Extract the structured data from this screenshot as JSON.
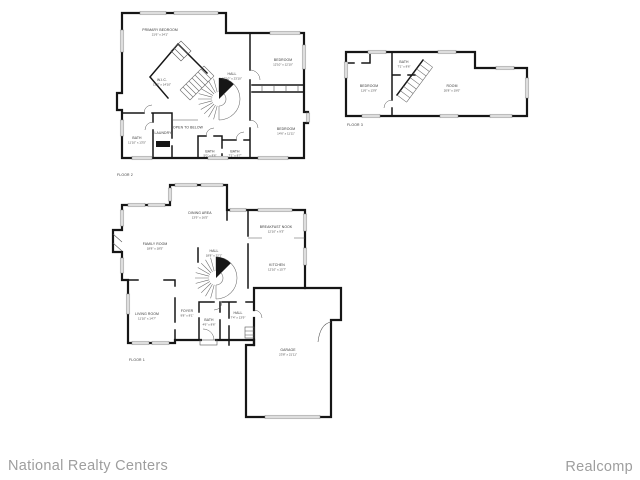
{
  "page": {
    "background": "#ffffff"
  },
  "colors": {
    "wall": "#161616",
    "window": "#dedede",
    "stair": "#6a6a6a",
    "label": "#333333",
    "footer": "#9e9e9e"
  },
  "footer": {
    "left": "National Realty Centers",
    "right": "Realcomp"
  },
  "floor2": {
    "label": "FLOOR 2",
    "rooms": [
      {
        "name": "PRIMARY BEDROOM",
        "dims": "21'6\" x 24'1\""
      },
      {
        "name": "W.I.C.",
        "dims": "13'2\" x 14'10\""
      },
      {
        "name": "HALL",
        "dims": "12'10\" x 23'10\""
      },
      {
        "name": "BEDROOM",
        "dims": "12'10\" x 12'10\""
      },
      {
        "name": "BEDROOM",
        "dims": "14'6\" x 11'11\""
      },
      {
        "name": "BATH",
        "dims": "11'10\" x 13'5\""
      },
      {
        "name": "LAUNDRY",
        "dims": ""
      },
      {
        "name": "OPEN TO BELOW",
        "dims": ""
      },
      {
        "name": "BATH",
        "dims": "5'0\" x 8'6\""
      },
      {
        "name": "BATH",
        "dims": "7'1\" x 8'7\""
      }
    ]
  },
  "floor3": {
    "label": "FLOOR 3",
    "rooms": [
      {
        "name": "BEDROOM",
        "dims": "11'6\" x 13'9\""
      },
      {
        "name": "BATH",
        "dims": "7'1\" x 8'6\""
      },
      {
        "name": "ROOM",
        "dims": "20'8\" x 19'0\""
      }
    ]
  },
  "floor1": {
    "label": "FLOOR 1",
    "rooms": [
      {
        "name": "DINING AREA",
        "dims": "13'9\" x 16'5\""
      },
      {
        "name": "FAMILY ROOM",
        "dims": "18'8\" x 18'5\""
      },
      {
        "name": "BREAKFAST NOOK",
        "dims": "12'10\" x 9'3\""
      },
      {
        "name": "KITCHEN",
        "dims": "12'10\" x 15'7\""
      },
      {
        "name": "HALL",
        "dims": "18'8\" x 22'1\""
      },
      {
        "name": "LIVING ROOM",
        "dims": "11'10\" x 14'7\""
      },
      {
        "name": "FOYER",
        "dims": "9'8\" x 8'1\""
      },
      {
        "name": "BATH",
        "dims": "4'6\" x 8'6\""
      },
      {
        "name": "HALL",
        "dims": "7'4\" x 13'9\""
      },
      {
        "name": "GARAGE",
        "dims": "23'8\" x 21'11\""
      }
    ]
  }
}
